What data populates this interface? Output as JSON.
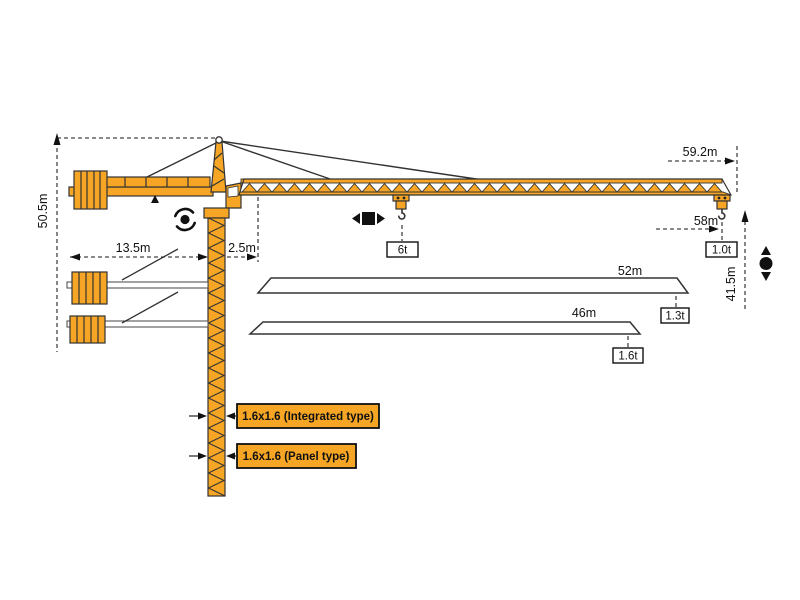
{
  "diagram": {
    "dimensions": {
      "total_height": "50.5m",
      "tail_radius": "13.5m",
      "root_offset": "2.5m",
      "tip_radius": "59.2m",
      "max_hook_radius": "58m",
      "hook_height": "41.5m"
    },
    "capacities": {
      "max_load": "6t",
      "tip_load": "1.0t"
    },
    "jib_options": [
      {
        "length": "52m",
        "tip_load": "1.3t"
      },
      {
        "length": "46m",
        "tip_load": "1.6t"
      }
    ],
    "mast_sections": [
      {
        "label": "1.6x1.6 (Integrated type)"
      },
      {
        "label": "1.6x1.6 (Panel type)"
      }
    ],
    "icons": {
      "slewing": "rotation-arrows-around-dot",
      "trolley_travel": "left-right-arrows-square",
      "hoisting": "up-down-arrows-circle"
    },
    "colors": {
      "crane_orange": "#F6A624",
      "outline": "#333333",
      "dash_line": "#444444",
      "text": "#111111",
      "white": "#FFFFFF"
    }
  }
}
